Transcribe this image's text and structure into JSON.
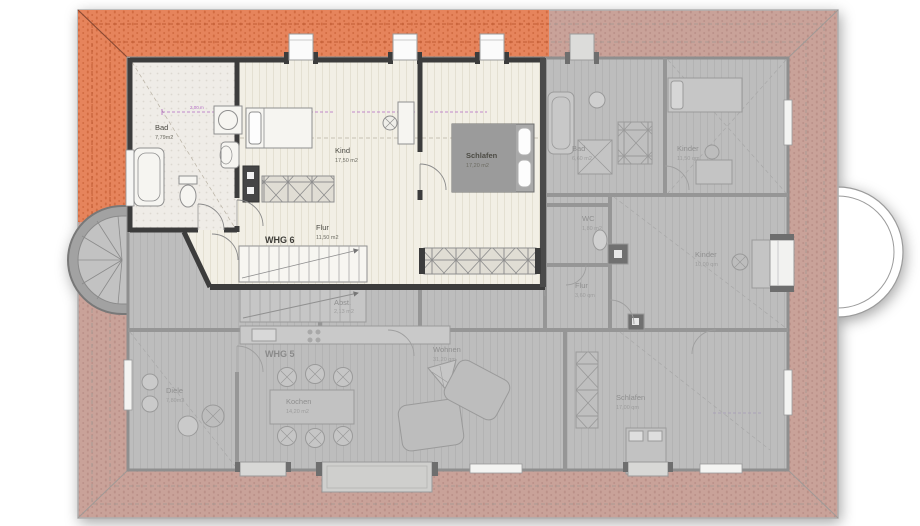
{
  "plan_type": "floor-plan",
  "apartments": {
    "whg6": {
      "label": "WHG 6",
      "rooms": {
        "bad": {
          "name": "Bad",
          "area": "7,79m2"
        },
        "kind": {
          "name": "Kind",
          "area": "17,50 m2"
        },
        "schlafen": {
          "name": "Schlafen",
          "area": "17,20 m2"
        },
        "flur": {
          "name": "Flur",
          "area": "11,50 m2"
        }
      }
    },
    "right_unit": {
      "rooms": {
        "bad": {
          "name": "Bad",
          "area": "6,60 m2"
        },
        "wc": {
          "name": "WC",
          "area": "1,80 m2"
        },
        "kinder1": {
          "name": "Kinder",
          "area": "11,50 qm"
        },
        "kinder2": {
          "name": "Kinder",
          "area": "10,00 qm"
        },
        "flur": {
          "name": "Flur",
          "area": "3,60 qm"
        }
      }
    },
    "whg5": {
      "label": "WHG 5",
      "rooms": {
        "diele": {
          "name": "Diele",
          "area": "7,80m2"
        },
        "kochen": {
          "name": "Kochen",
          "area": "14,20 m2"
        },
        "wohnen": {
          "name": "Wohnen",
          "area": "31,20 qm"
        },
        "abst": {
          "name": "Abst.",
          "area": "2,13 m2"
        },
        "schlafen": {
          "name": "Schlafen",
          "area": "17,00 qm"
        }
      }
    }
  },
  "dimensions": {
    "headroom_line": "2,00 m"
  },
  "colors": {
    "roof_highlight": "#e6845c",
    "roof_faded": "#c9a299",
    "floor_highlight": "#f2efe5",
    "floor_faded": "#bdbdbd",
    "wall_dark": "#3c3c3c",
    "wall_gray": "#969696",
    "dimension_purple": "#b36ac4"
  }
}
